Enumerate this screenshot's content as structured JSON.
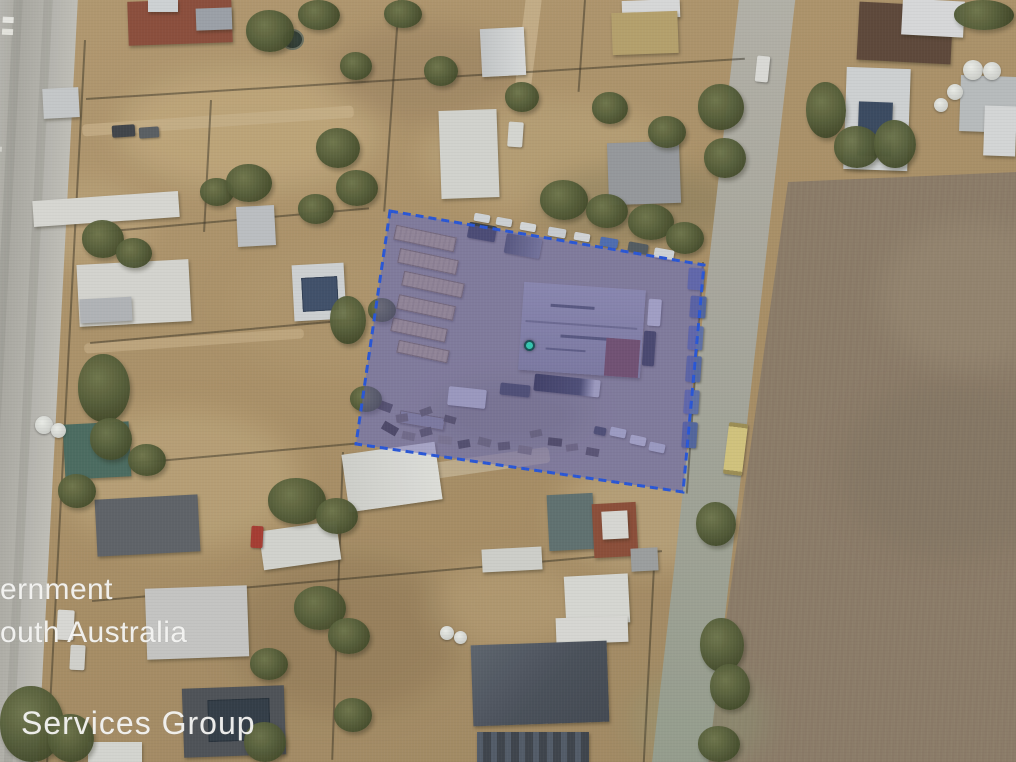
{
  "watermark": {
    "line1": "ernment",
    "line2": "outh Australia",
    "line3": "Services Group"
  },
  "colors": {
    "parcel_fill": "rgba(95,88,178,0.44)",
    "parcel_border": "#2353d9",
    "marker_fill": "#2fc7b2",
    "marker_border": "#134b52"
  }
}
